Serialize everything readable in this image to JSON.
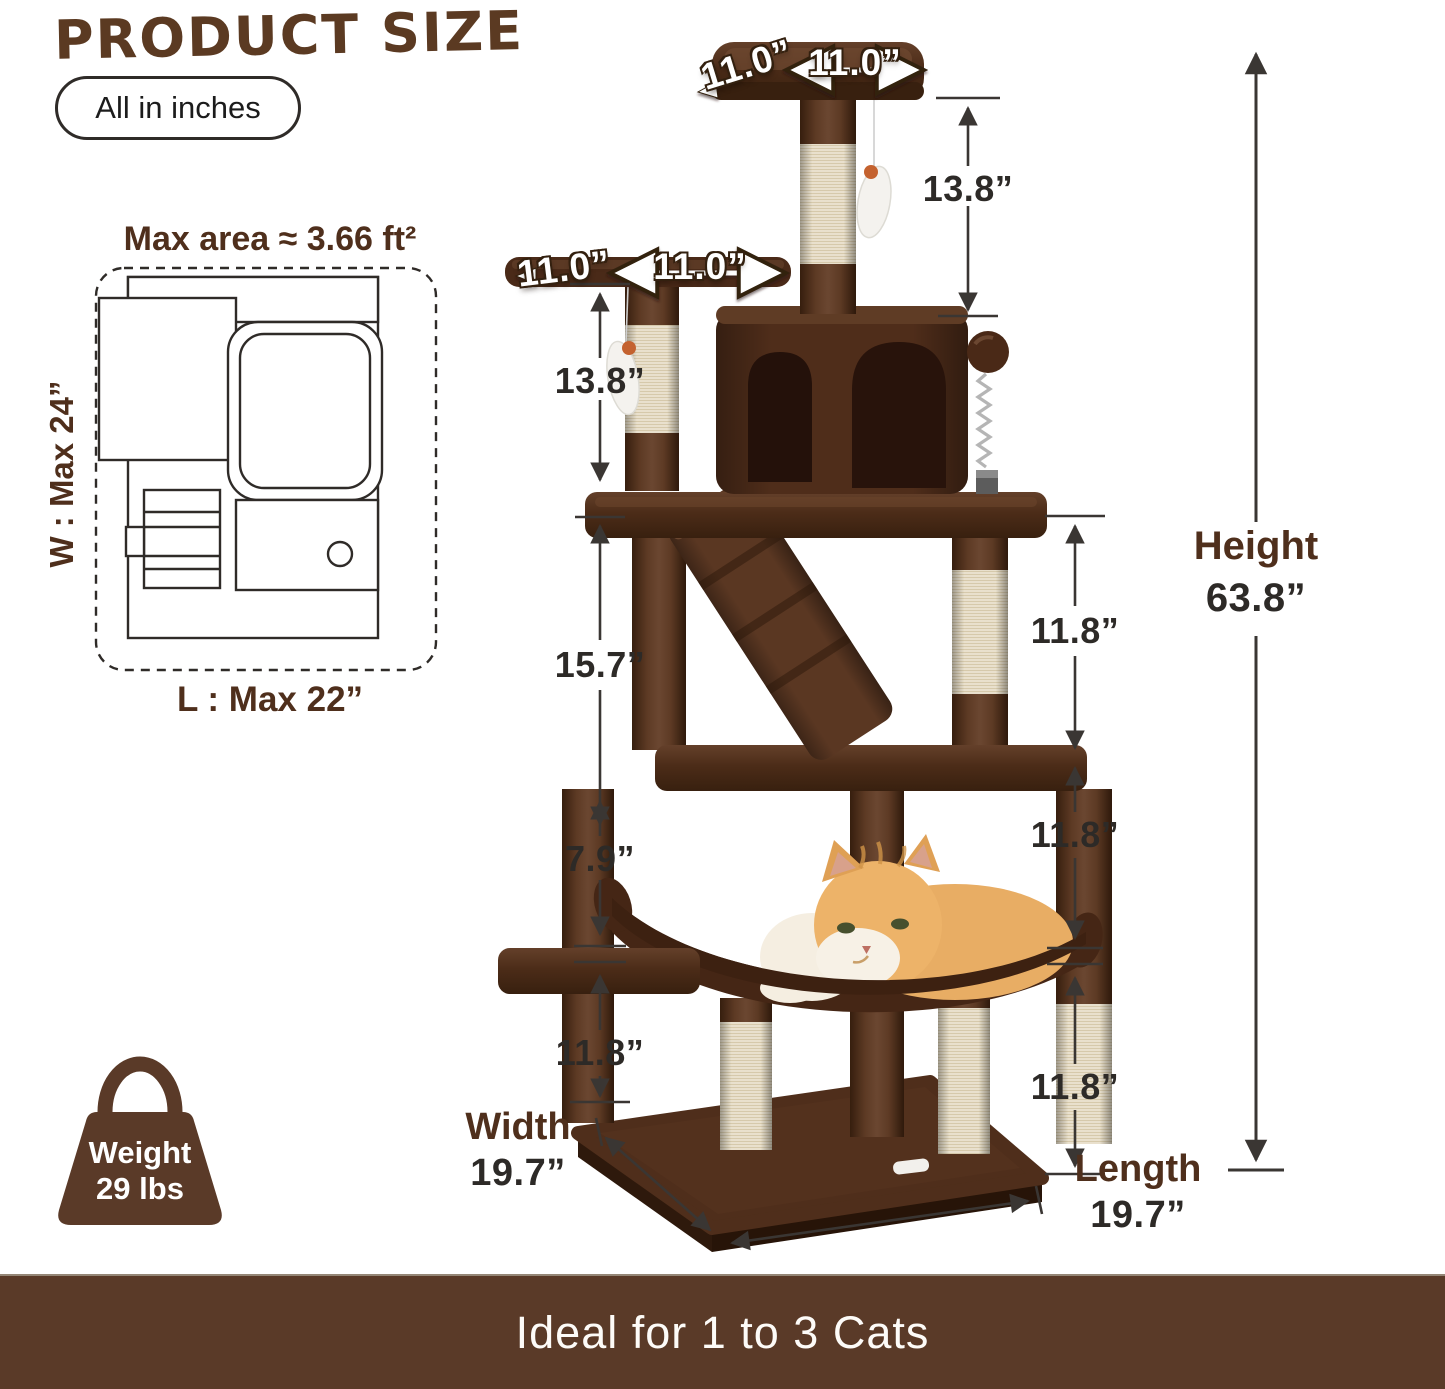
{
  "header": {
    "title": "PRODUCT SIZE",
    "units_note": "All in inches"
  },
  "footprint": {
    "max_area_label": "Max area ≈ 3.66 ft²",
    "width_label": "W : Max 24”",
    "length_label": "L : Max 22”"
  },
  "tree_dimensions": {
    "top_platform_left": "11.0”",
    "top_platform_right": "11.0”",
    "upper_post": "13.8”",
    "second_platform_left": "11.0”",
    "second_platform_right": "11.0”",
    "second_post": "13.8”",
    "middle_section": "15.7”",
    "upper_right_post": "11.8”",
    "hammock_gap": "7.9”",
    "middle_right_post": "11.8”",
    "lower_left_post": "11.8”",
    "lower_right_post": "11.8”"
  },
  "overall": {
    "height_label": "Height",
    "height_value": "63.8”",
    "width_label": "Width",
    "width_value": "19.7”",
    "length_label": "Length",
    "length_value": "19.7”"
  },
  "weight_badge": {
    "label": "Weight",
    "value": "29 lbs"
  },
  "footer": {
    "text": "Ideal for 1 to 3 Cats"
  },
  "colors": {
    "plush_brown": "#54311d",
    "plush_dark": "#331b0c",
    "plush_light": "#6d4830",
    "sisal": "#ece4d2",
    "banner_brown": "#5a3a28",
    "accent_text_brown": "#4f2f1c",
    "measure_text": "#2d2a27",
    "arrow_dark": "#3a3633"
  }
}
